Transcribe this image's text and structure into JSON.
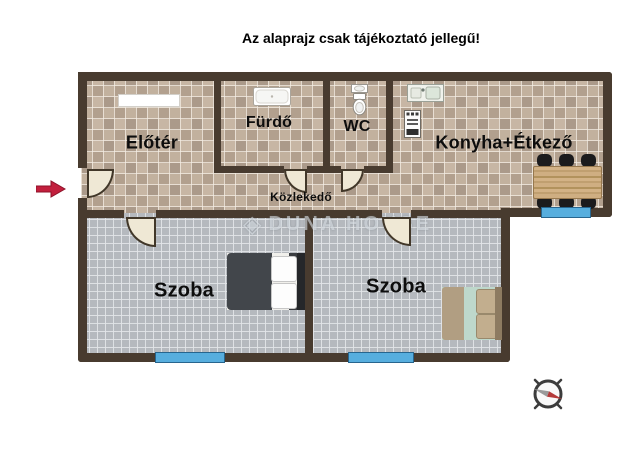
{
  "title": "Az alaprajz csak tájékoztató jellegű!",
  "rooms": [
    {
      "name": "elotér",
      "label": "Előtér"
    },
    {
      "name": "furdo",
      "label": "Fürdő"
    },
    {
      "name": "wc",
      "label": "WC"
    },
    {
      "name": "konyha-etkezo",
      "label": "Konyha+Étkező"
    },
    {
      "name": "kozlekedo",
      "label": "Közlekedő"
    },
    {
      "name": "szoba-1",
      "label": "Szoba"
    },
    {
      "name": "szoba-2",
      "label": "Szoba"
    }
  ],
  "watermark": {
    "text": "DUNA HOUSE",
    "logo": "diamond-icon"
  },
  "colors": {
    "wall": "#483b2f",
    "tile_floor": "#bcab99",
    "carpet_floor": "#b5b9be",
    "window": "#57aede",
    "door": "#efe8d5",
    "entrance_arrow": "#c21f3d",
    "compass_needle_red": "#b43a3a",
    "compass_needle_gray": "#9a9a9a",
    "title_text": "#000000"
  }
}
